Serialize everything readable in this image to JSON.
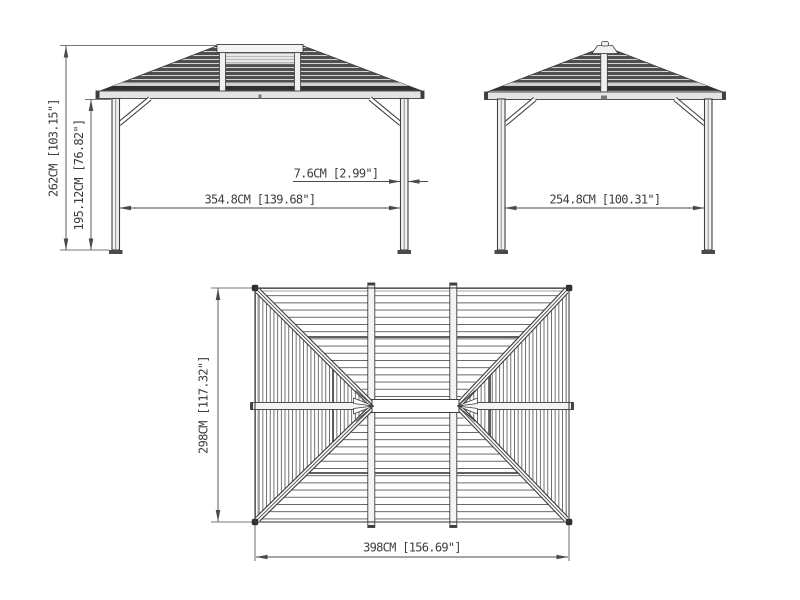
{
  "drawing": {
    "title": "gazebo-dimension-diagram",
    "background": "#ffffff",
    "line_color": "#3f3f3f",
    "dimension_color": "#4a4a4a",
    "views": {
      "front": {
        "dim_total_height": "262CM [103.15\"]",
        "dim_post_height": "195.12CM [76.82\"]",
        "dim_inner_width": "354.8CM [139.68\"]",
        "dim_post_width": "7.6CM [2.99\"]"
      },
      "side": {
        "dim_inner_width": "254.8CM [100.31\"]"
      },
      "top": {
        "dim_depth": "298CM [117.32\"]",
        "dim_width": "398CM [156.69\"]"
      }
    }
  }
}
